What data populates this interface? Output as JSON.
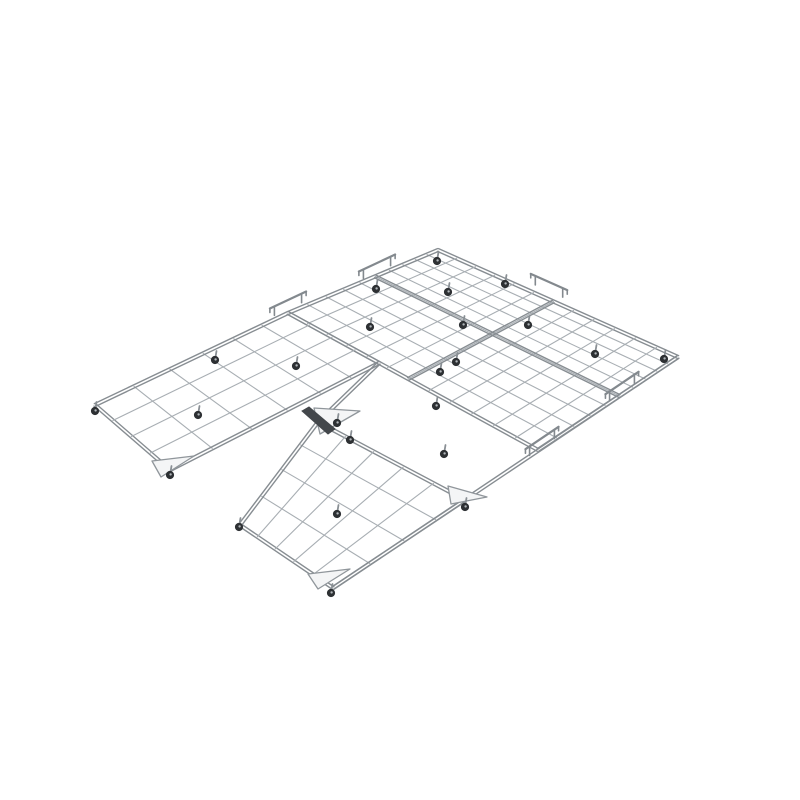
{
  "page": {
    "background": "#ffffff",
    "width": 800,
    "height": 800
  },
  "figure": {
    "description": "3D render of a modular wire-grid rolling platform: flat gray mesh panels on small black casters, joined by raised edge brackets, hinge blocks and triangular corner gussets; the front-left panel bay is empty forming a notch.",
    "colors": {
      "background": "#ffffff",
      "wire": "#a8aeb3",
      "wire_light": "#c0c5c9",
      "border": "#878d92",
      "seam": "#7f858a",
      "rail": "#83898e",
      "block_dark": "#43474b",
      "wheel": "#2d3033",
      "wheel_hub": "#b0b5b9",
      "stem": "#8a9095",
      "gusset_fill": "#f4f5f6",
      "gusset_stroke": "#90969b"
    },
    "panels": [
      {
        "id": "main-section",
        "quad": [
          [
            438,
            250
          ],
          [
            678,
            357
          ],
          [
            538,
            450
          ],
          [
            288,
            313
          ]
        ],
        "cells_a": 12,
        "cells_b": 10,
        "grow_a": 1.15,
        "grow_b": 1.8
      },
      {
        "id": "left-panel",
        "quad": [
          [
            288,
            313
          ],
          [
            379,
            363
          ],
          [
            170,
            470
          ],
          [
            95,
            405
          ]
        ],
        "cells_a": 4,
        "cells_b": 6,
        "grow_a": 1.1,
        "grow_b": 1.5
      },
      {
        "id": "bottom-panel",
        "quad": [
          [
            318,
            422
          ],
          [
            465,
            500
          ],
          [
            333,
            588
          ],
          [
            240,
            525
          ]
        ],
        "cells_a": 5,
        "cells_b": 4,
        "grow_a": 1.15,
        "grow_b": 1.25
      }
    ],
    "seams": [
      {
        "panel": "main-section",
        "axis": "a",
        "index": 6
      },
      {
        "panel": "main-section",
        "axis": "b",
        "index": 5
      }
    ],
    "rails": [
      {
        "id": "right-front-outer-rail",
        "from": [
          678,
          357
        ],
        "to": [
          333,
          588
        ]
      },
      {
        "id": "left-connector-rail",
        "from": [
          379,
          363
        ],
        "to": [
          318,
          422
        ]
      }
    ],
    "gussets": [
      {
        "id": "left-panel-front-corner-gusset",
        "points": [
          [
            152,
            461
          ],
          [
            194,
            456
          ],
          [
            161,
            477
          ]
        ]
      },
      {
        "id": "bottom-panel-south-corner-gusset",
        "points": [
          [
            308,
            574
          ],
          [
            350,
            569
          ],
          [
            318,
            589
          ]
        ]
      },
      {
        "id": "bottom-panel-rear-right-gusset",
        "points": [
          [
            448,
            486
          ],
          [
            487,
            497
          ],
          [
            451,
            504
          ]
        ]
      },
      {
        "id": "hinge-gusset",
        "points": [
          [
            314,
            408
          ],
          [
            360,
            411
          ],
          [
            320,
            434
          ]
        ]
      }
    ],
    "blocks": [
      {
        "id": "hinge-block",
        "quad": [
          [
            302,
            411
          ],
          [
            309,
            407
          ],
          [
            335,
            429
          ],
          [
            328,
            434
          ]
        ]
      }
    ],
    "brackets": [
      {
        "id": "edge-bracket-1",
        "center": [
          288,
          309
        ],
        "dir": [
          0.906,
          -0.423
        ],
        "len": 30
      },
      {
        "id": "edge-bracket-2",
        "center": [
          377,
          272
        ],
        "dir": [
          0.906,
          -0.423
        ],
        "len": 30
      },
      {
        "id": "edge-bracket-3",
        "center": [
          549,
          291
        ],
        "dir": [
          0.913,
          0.407
        ],
        "len": 30
      },
      {
        "id": "edge-bracket-4",
        "center": [
          622,
          392
        ],
        "dir": [
          -0.828,
          0.561
        ],
        "len": 30
      },
      {
        "id": "edge-bracket-5",
        "center": [
          542,
          447
        ],
        "dir": [
          -0.828,
          0.561
        ],
        "len": 30
      }
    ],
    "casters": [
      [
        95,
        411
      ],
      [
        170,
        475
      ],
      [
        198,
        415
      ],
      [
        215,
        360
      ],
      [
        296,
        366
      ],
      [
        370,
        327
      ],
      [
        376,
        289
      ],
      [
        437,
        261
      ],
      [
        448,
        292
      ],
      [
        505,
        284
      ],
      [
        463,
        325
      ],
      [
        528,
        325
      ],
      [
        456,
        362
      ],
      [
        595,
        354
      ],
      [
        664,
        359
      ],
      [
        440,
        372
      ],
      [
        436,
        406
      ],
      [
        337,
        423
      ],
      [
        350,
        440
      ],
      [
        444,
        454
      ],
      [
        337,
        514
      ],
      [
        239,
        527
      ],
      [
        331,
        593
      ],
      [
        465,
        507
      ]
    ]
  }
}
